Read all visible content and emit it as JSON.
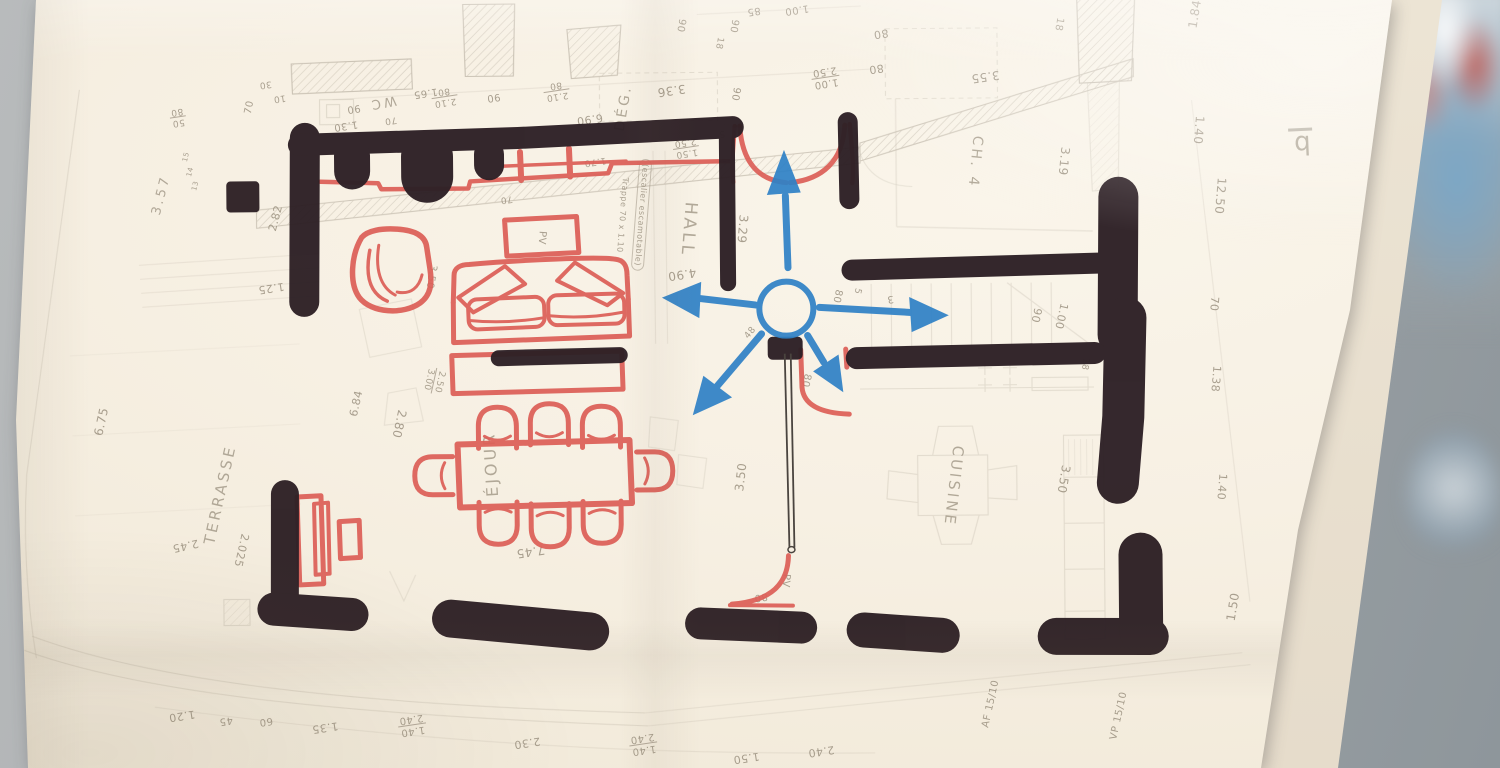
{
  "scene": {
    "description": "Photograph of a folded hand-drawn architectural floor plan annotated with dark marker walls, red marker furniture and blue circulation arrows",
    "paper_color": "#f7f0e3",
    "background_color": "#a3a9ac",
    "ink": {
      "wall_marker": "#2e2126",
      "furniture_marker": "#dc5e56",
      "annotation_blue": "#2e81c6",
      "pencil": "#968c7b"
    }
  },
  "plan": {
    "rooms": [
      {
        "name": "TERRASSE"
      },
      {
        "name": "SÉJOUR",
        "visible_text": "ÉJOUR"
      },
      {
        "name": "HALL"
      },
      {
        "name": "WC"
      },
      {
        "name": "DÉG."
      },
      {
        "name": "CH. 4"
      },
      {
        "name": "CUISINE"
      }
    ],
    "notes": [
      "Trappe 70 x 1.10",
      "(escalier escamotable)",
      "AF 15/10",
      "VP 15/10",
      "PV",
      "b"
    ],
    "labels": [
      {
        "t": "3.57",
        "x": 163,
        "y": 190,
        "r": -75,
        "s": 13
      },
      {
        "t": "70",
        "x": 252,
        "y": 103,
        "r": -78,
        "s": 10
      },
      {
        "t": "30",
        "x": 268,
        "y": 80,
        "r": 172,
        "s": 9
      },
      {
        "t": "10",
        "x": 282,
        "y": 94,
        "r": 172,
        "s": 9
      },
      {
        "t": "50/80",
        "x": 180,
        "y": 112,
        "r": 172,
        "s": 9,
        "k": "f"
      },
      {
        "t": "15",
        "x": 188,
        "y": 152,
        "r": -75,
        "s": 7
      },
      {
        "t": "14",
        "x": 192,
        "y": 167,
        "r": -75,
        "s": 7
      },
      {
        "t": "13",
        "x": 197,
        "y": 181,
        "r": -75,
        "s": 7
      },
      {
        "t": "2.82",
        "x": 277,
        "y": 214,
        "r": -75,
        "s": 11
      },
      {
        "t": "WC",
        "x": 385,
        "y": 99,
        "r": 170,
        "s": 13
      },
      {
        "t": "1.65",
        "x": 428,
        "y": 90,
        "r": 172,
        "s": 10
      },
      {
        "t": "90",
        "x": 356,
        "y": 105,
        "r": 172,
        "s": 10
      },
      {
        "t": "1.30",
        "x": 348,
        "y": 122,
        "r": 172,
        "s": 10
      },
      {
        "t": "70",
        "x": 393,
        "y": 117,
        "r": 172,
        "s": 9
      },
      {
        "t": "2.10/80",
        "x": 447,
        "y": 94,
        "r": 172,
        "s": 9,
        "k": "f"
      },
      {
        "t": "90",
        "x": 496,
        "y": 95,
        "r": 172,
        "s": 10
      },
      {
        "t": "2.10/80",
        "x": 559,
        "y": 89,
        "r": 172,
        "s": 9,
        "k": "f"
      },
      {
        "t": "6.90",
        "x": 592,
        "y": 118,
        "r": 172,
        "s": 11
      },
      {
        "t": "DÉG.",
        "x": 626,
        "y": 107,
        "r": -80,
        "s": 14
      },
      {
        "t": "3.36",
        "x": 674,
        "y": 90,
        "r": 172,
        "s": 12
      },
      {
        "t": "90",
        "x": 684,
        "y": 25,
        "r": 100,
        "s": 10
      },
      {
        "t": "90",
        "x": 737,
        "y": 26,
        "r": 100,
        "s": 10
      },
      {
        "t": "85",
        "x": 757,
        "y": 11,
        "r": 172,
        "s": 10
      },
      {
        "t": "1.00",
        "x": 800,
        "y": 10,
        "r": 172,
        "s": 10
      },
      {
        "t": "18",
        "x": 722,
        "y": 43,
        "r": 100,
        "s": 9
      },
      {
        "t": "90",
        "x": 738,
        "y": 94,
        "r": 100,
        "s": 10
      },
      {
        "t": "80",
        "x": 884,
        "y": 35,
        "r": 172,
        "s": 11
      },
      {
        "t": "80",
        "x": 879,
        "y": 70,
        "r": 172,
        "s": 11
      },
      {
        "t": "1.00/2.50",
        "x": 828,
        "y": 78,
        "r": 172,
        "s": 10,
        "k": "f"
      },
      {
        "t": "3.55",
        "x": 988,
        "y": 79,
        "r": 172,
        "s": 12
      },
      {
        "t": "18",
        "x": 1062,
        "y": 27,
        "r": 100,
        "s": 10
      },
      {
        "t": "1.84",
        "x": 1198,
        "y": 18,
        "r": -80,
        "s": 12
      },
      {
        "t": "5",
        "x": 724,
        "y": 133,
        "r": 172,
        "s": 9
      },
      {
        "t": "1.50/2.50",
        "x": 688,
        "y": 147,
        "r": 172,
        "s": 9,
        "k": "f"
      },
      {
        "t": "1.70",
        "x": 597,
        "y": 160,
        "r": 172,
        "s": 9
      },
      {
        "t": "CH. 4",
        "x": 977,
        "y": 164,
        "r": 96,
        "s": 14
      },
      {
        "t": "3.19",
        "x": 1066,
        "y": 164,
        "r": 96,
        "s": 12
      },
      {
        "t": "1.40",
        "x": 1201,
        "y": 134,
        "r": 95,
        "s": 12
      },
      {
        "t": "12.50",
        "x": 1222,
        "y": 200,
        "r": 95,
        "s": 12
      },
      {
        "t": "b",
        "x": 1303,
        "y": 147,
        "r": 178,
        "s": 26,
        "k": "bar"
      },
      {
        "t": "HALL",
        "x": 690,
        "y": 229,
        "r": 95,
        "s": 17
      },
      {
        "t": "3.29",
        "x": 744,
        "y": 229,
        "r": 95,
        "s": 12
      },
      {
        "t": "Trappe 70 x 1.10",
        "x": 624,
        "y": 214,
        "r": 95,
        "s": 8
      },
      {
        "t": "(escalier escamotable)",
        "x": 643,
        "y": 214,
        "r": 95,
        "s": 8,
        "k": "box"
      },
      {
        "t": "PV",
        "x": 543,
        "y": 236,
        "r": 95,
        "s": 10
      },
      {
        "t": "70",
        "x": 508,
        "y": 197,
        "r": 172,
        "s": 9
      },
      {
        "t": "3.50",
        "x": 432,
        "y": 274,
        "r": 100,
        "s": 10
      },
      {
        "t": "4.90",
        "x": 683,
        "y": 274,
        "r": 172,
        "s": 12
      },
      {
        "t": "80",
        "x": 838,
        "y": 297,
        "r": 103,
        "s": 10
      },
      {
        "t": "5",
        "x": 858,
        "y": 292,
        "r": 103,
        "s": 9
      },
      {
        "t": "3",
        "x": 891,
        "y": 300,
        "r": 172,
        "s": 10
      },
      {
        "t": "48",
        "x": 751,
        "y": 333,
        "r": -50,
        "s": 9
      },
      {
        "t": "90",
        "x": 1037,
        "y": 318,
        "r": 103,
        "s": 11
      },
      {
        "t": "1.00",
        "x": 1062,
        "y": 319,
        "r": 103,
        "s": 11
      },
      {
        "t": "70",
        "x": 1215,
        "y": 308,
        "r": 95,
        "s": 11
      },
      {
        "t": "1.38",
        "x": 1216,
        "y": 383,
        "r": 95,
        "s": 11
      },
      {
        "t": "1.40",
        "x": 1221,
        "y": 491,
        "r": 95,
        "s": 11
      },
      {
        "t": "1.25",
        "x": 272,
        "y": 284,
        "r": 172,
        "s": 11
      },
      {
        "t": "6.75",
        "x": 101,
        "y": 416,
        "r": -77,
        "s": 12
      },
      {
        "t": "TERRASSE",
        "x": 219,
        "y": 490,
        "r": -77,
        "s": 15
      },
      {
        "t": "2.80",
        "x": 399,
        "y": 421,
        "r": 103,
        "s": 12
      },
      {
        "t": "6.84",
        "x": 356,
        "y": 400,
        "r": -77,
        "s": 11
      },
      {
        "t": "2.50/3.00",
        "x": 434,
        "y": 378,
        "r": 103,
        "s": 9,
        "k": "f"
      },
      {
        "t": "2.45",
        "x": 184,
        "y": 541,
        "r": 168,
        "s": 11
      },
      {
        "t": "2.025",
        "x": 240,
        "y": 546,
        "r": 103,
        "s": 11
      },
      {
        "t": "ÉJOUR",
        "x": 490,
        "y": 462,
        "r": -93,
        "s": 16
      },
      {
        "t": "7.45",
        "x": 529,
        "y": 550,
        "r": 172,
        "s": 12
      },
      {
        "t": "CUISINE",
        "x": 953,
        "y": 488,
        "r": 97,
        "s": 15
      },
      {
        "t": "3.50",
        "x": 1063,
        "y": 482,
        "r": 100,
        "s": 12
      },
      {
        "t": "3.50",
        "x": 740,
        "y": 477,
        "r": -83,
        "s": 12
      },
      {
        "t": "18",
        "x": 1085,
        "y": 367,
        "r": 100,
        "s": 9
      },
      {
        "t": "1.20",
        "x": 179,
        "y": 711,
        "r": 172,
        "s": 11
      },
      {
        "t": "45",
        "x": 223,
        "y": 716,
        "r": 172,
        "s": 10
      },
      {
        "t": "60",
        "x": 263,
        "y": 717,
        "r": 172,
        "s": 10
      },
      {
        "t": "1.35",
        "x": 322,
        "y": 724,
        "r": 172,
        "s": 11
      },
      {
        "t": "1.40/2.40",
        "x": 409,
        "y": 722,
        "r": 172,
        "s": 10,
        "k": "f"
      },
      {
        "t": "2.30",
        "x": 524,
        "y": 741,
        "r": 172,
        "s": 11
      },
      {
        "t": "1.40/2.40",
        "x": 640,
        "y": 743,
        "r": 172,
        "s": 10,
        "k": "f"
      },
      {
        "t": "1.50",
        "x": 743,
        "y": 758,
        "r": 172,
        "s": 11
      },
      {
        "t": "2.40",
        "x": 818,
        "y": 752,
        "r": 172,
        "s": 11
      },
      {
        "t": "80",
        "x": 759,
        "y": 597,
        "r": 172,
        "s": 10
      },
      {
        "t": "PV",
        "x": 784,
        "y": 581,
        "r": 95,
        "s": 10
      },
      {
        "t": "80",
        "x": 806,
        "y": 381,
        "r": 103,
        "s": 10
      },
      {
        "t": "AF 15/10",
        "x": 988,
        "y": 706,
        "r": -77,
        "s": 10
      },
      {
        "t": "VP 15/10",
        "x": 1116,
        "y": 719,
        "r": -77,
        "s": 10
      },
      {
        "t": "1.50",
        "x": 1231,
        "y": 611,
        "r": -80,
        "s": 12
      }
    ]
  },
  "annotations": {
    "color": "#2e81c6",
    "circle": {
      "cx": 787,
      "cy": 309,
      "r": 27
    },
    "arrows": [
      {
        "dir": "up"
      },
      {
        "dir": "left"
      },
      {
        "dir": "right"
      },
      {
        "dir": "down-left"
      },
      {
        "dir": "down-right"
      }
    ]
  },
  "red_furniture": [
    "armchair",
    "sofa",
    "console",
    "sideboard",
    "small-cabinet",
    "dining-table",
    "eight-chairs",
    "pv-box",
    "radiator",
    "entrance-curtain-door",
    "kitchen-door-swing",
    "bottom-door-swing"
  ]
}
